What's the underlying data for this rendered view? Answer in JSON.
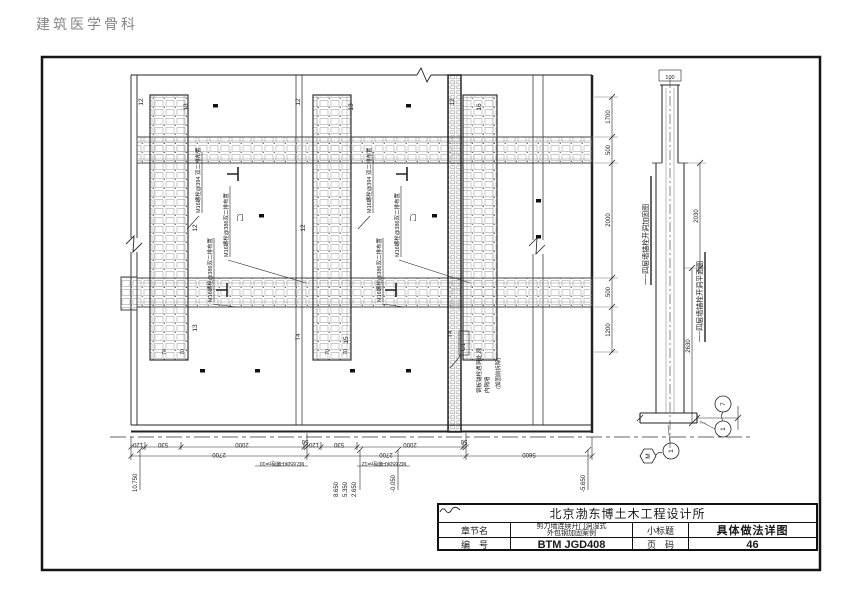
{
  "page": {
    "header_title": "建筑医学骨科"
  },
  "elevation": {
    "pier_labels": [
      "12",
      "13",
      "12",
      "13",
      "12",
      "16",
      "12",
      "12",
      "13",
      "T4",
      "15",
      "T4"
    ],
    "dim_70": "70",
    "door_label": "门",
    "g1_label": "G1",
    "bolt_note_394": "M16螺栓@394 双二排布置",
    "bolt_note_386": "M16螺栓@386双二排布置",
    "removal_note": [
      "钢板锚栓遇洞处,原",
      "内隔墙",
      "(加固前拆除)"
    ],
    "dims_bottom": [
      "120",
      "530",
      "2000",
      "50",
      "120",
      "530",
      "2000",
      "50"
    ],
    "dims_totals": [
      "2700",
      "2700",
      "5600"
    ],
    "anchor_count_notes": [
      "M2.650KF螺栓n=10",
      "M2.650KF螺栓n=12"
    ],
    "level_marks": [
      "10.750",
      "8.650",
      "5.350",
      "2.650",
      "-0.050",
      "-5.650"
    ]
  },
  "section": {
    "dims_left": [
      "1700",
      "500",
      "2000",
      "500",
      "1200"
    ],
    "dim_right_upper": "2030",
    "dim_right_lower": "2630",
    "dim_top": "100",
    "title_elevation_view": "一~四层墙锚栓开洞加固图",
    "title_plan_view": "一~四层墙锚栓开洞平面图",
    "bubbles": [
      "M",
      "1",
      "7",
      "1"
    ]
  },
  "title_block": {
    "company": "北京渤东博土木工程设计所",
    "chapter_label": "章节名",
    "chapter_value_line1": "剪力墙连续开门洞湿式",
    "chapter_value_line2": "外包钢加固案例",
    "subtitle_label": "小标题",
    "subtitle_value": "具体做法详图",
    "number_label": "编　号",
    "number_value": "BTM JGD408",
    "page_label": "页　码",
    "page_value": "46"
  }
}
